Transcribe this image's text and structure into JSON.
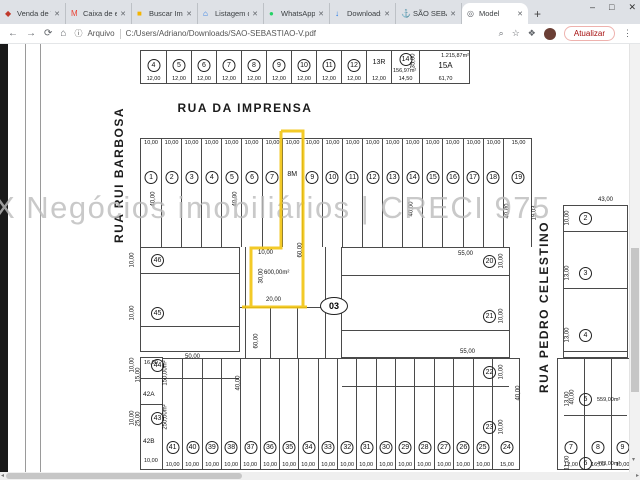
{
  "browser": {
    "tabs": [
      {
        "label": "Venda de Terr",
        "icon": "listing-pin",
        "glyph": "◆",
        "color": "#c0392b",
        "active": false
      },
      {
        "label": "Caixa de entra",
        "icon": "gmail",
        "glyph": "M",
        "color": "#ea4335",
        "active": false
      },
      {
        "label": "Buscar Imóve",
        "icon": "yellow-site",
        "glyph": "■",
        "color": "#f4b400",
        "active": false
      },
      {
        "label": "Listagem de i",
        "icon": "home-site",
        "glyph": "⌂",
        "color": "#1a73e8",
        "active": false
      },
      {
        "label": "WhatsApp",
        "icon": "whatsapp",
        "glyph": "●",
        "color": "#25d366",
        "active": false
      },
      {
        "label": "Downloads",
        "icon": "downloads",
        "glyph": "↓",
        "color": "#1a73e8",
        "active": false
      },
      {
        "label": "SÃO SEBASTI",
        "icon": "anchor",
        "glyph": "⚓",
        "color": "#34495e",
        "active": false
      },
      {
        "label": "Model",
        "icon": "globe",
        "glyph": "◎",
        "color": "#5f6368",
        "active": true
      }
    ],
    "close_glyph": "✕",
    "new_tab_glyph": "+",
    "window_controls": {
      "minimize": "–",
      "maximize": "□",
      "close": "✕"
    },
    "nav": {
      "back": "←",
      "forward": "→",
      "reload": "⟳",
      "home": "⌂",
      "info": "ⓘ"
    },
    "address": {
      "scheme_label": "Arquivo",
      "path": "C:/Users/Adriano/Downloads/SAO-SEBASTIAO-V.pdf"
    },
    "toolbar_right": {
      "zoom_glyph": "⌕",
      "bookmark_glyph": "☆",
      "extensions_glyph": "❖",
      "update_button": "Atualizar",
      "menu_glyph": "⋮"
    },
    "scroll_glyphs": {
      "down": "▾",
      "right": "▸",
      "left": "◂"
    }
  },
  "map": {
    "watermark": "X Negócios imobiliários | CRECI 975",
    "streets": {
      "top": "RUA DA IMPRENSA",
      "left": "RUA RUI BARBOSA",
      "right": "RUA PEDRO CELESTINO"
    },
    "block_label": "03",
    "highlight": {
      "lot": "8M",
      "color": "#f2c40f"
    },
    "top_block": {
      "lots": [
        {
          "label": "4",
          "circled": true,
          "dim": "12,00"
        },
        {
          "label": "5",
          "circled": true,
          "dim": "12,00"
        },
        {
          "label": "6",
          "circled": true,
          "dim": "12,00"
        },
        {
          "label": "7",
          "circled": true,
          "dim": "12,00"
        },
        {
          "label": "8",
          "circled": true,
          "dim": "12,00"
        },
        {
          "label": "9",
          "circled": true,
          "dim": "12,00"
        },
        {
          "label": "10",
          "circled": true,
          "dim": "12,00"
        },
        {
          "label": "11",
          "circled": true,
          "dim": "12,00"
        },
        {
          "label": "12",
          "circled": true,
          "dim": "12,00"
        },
        {
          "label": "13R",
          "circled": false,
          "dim": "12,00"
        },
        {
          "label": "14",
          "circled": true,
          "area": "156,97m²",
          "dim": "14,50"
        },
        {
          "label": "15A",
          "circled": false,
          "area": "1.215,87m²",
          "dim": "61,70"
        }
      ]
    },
    "front_row": {
      "lots": [
        {
          "label": "1",
          "circled": true,
          "dim": "10,00"
        },
        {
          "label": "2",
          "circled": true,
          "dim": "10,00"
        },
        {
          "label": "3",
          "circled": true,
          "dim": "10,00"
        },
        {
          "label": "4",
          "circled": true,
          "dim": "10,00"
        },
        {
          "label": "5",
          "circled": true,
          "dim": "10,00"
        },
        {
          "label": "6",
          "circled": true,
          "dim": "10,00"
        },
        {
          "label": "7",
          "circled": true,
          "dim": "10,00"
        },
        {
          "label": "8M",
          "circled": false,
          "dim": "10,00",
          "highlight": true
        },
        {
          "label": "9",
          "circled": true,
          "dim": "10,00"
        },
        {
          "label": "10",
          "circled": true,
          "dim": "10,00"
        },
        {
          "label": "11",
          "circled": true,
          "dim": "10,00"
        },
        {
          "label": "12",
          "circled": true,
          "dim": "10,00"
        },
        {
          "label": "13",
          "circled": true,
          "dim": "10,00"
        },
        {
          "label": "14",
          "circled": true,
          "dim": "10,00"
        },
        {
          "label": "15",
          "circled": true,
          "dim": "10,00"
        },
        {
          "label": "16",
          "circled": true,
          "dim": "10,00"
        },
        {
          "label": "17",
          "circled": true,
          "dim": "10,00"
        },
        {
          "label": "18",
          "circled": true,
          "dim": "10,00"
        },
        {
          "label": "19",
          "circled": true,
          "dim": "15,00"
        }
      ]
    },
    "west_block": {
      "bottom_dim": "50,00",
      "lots": [
        {
          "label": "46",
          "side": "10,00"
        },
        {
          "label": "45",
          "side": "10,00"
        },
        {
          "label": "44",
          "side": "10,00"
        },
        {
          "label": "43",
          "side": "10,00"
        }
      ]
    },
    "lot_42a": {
      "label": "42A",
      "area": "150,00m²",
      "side": "15,00",
      "top_dim": "16,00"
    },
    "lot_42b": {
      "label": "42B",
      "area": "250,00m²",
      "side": "25,00",
      "bottom_dim": "10,00"
    },
    "back_row": {
      "lots": [
        {
          "label": "41",
          "circled": true,
          "dim": "10,00"
        },
        {
          "label": "40",
          "circled": true,
          "dim": "10,00"
        },
        {
          "label": "39",
          "circled": true,
          "dim": "10,00"
        },
        {
          "label": "38",
          "circled": true,
          "dim": "10,00"
        },
        {
          "label": "37",
          "circled": true,
          "dim": "10,00"
        },
        {
          "label": "36",
          "circled": true,
          "dim": "10,00"
        },
        {
          "label": "35",
          "circled": true,
          "dim": "10,00"
        },
        {
          "label": "34",
          "circled": true,
          "dim": "10,00"
        },
        {
          "label": "33",
          "circled": true,
          "dim": "10,00"
        },
        {
          "label": "32",
          "circled": true,
          "dim": "10,00"
        },
        {
          "label": "31",
          "circled": true,
          "dim": "10,00"
        },
        {
          "label": "30",
          "circled": true,
          "dim": "10,00"
        },
        {
          "label": "29",
          "circled": true,
          "dim": "10,00"
        },
        {
          "label": "28",
          "circled": true,
          "dim": "10,00"
        },
        {
          "label": "27",
          "circled": true,
          "dim": "10,00"
        },
        {
          "label": "26",
          "circled": true,
          "dim": "10,00"
        },
        {
          "label": "25",
          "circled": true,
          "dim": "10,00"
        },
        {
          "label": "24",
          "circled": true,
          "dim": "15,00"
        }
      ]
    },
    "east_mid_block": {
      "top_dim": "55,00",
      "bottom_dim": "55,00",
      "lots": [
        {
          "label": "20",
          "side": "10,00"
        },
        {
          "label": "21",
          "side": "10,00"
        },
        {
          "label": "22",
          "side": "10,00"
        },
        {
          "label": "23",
          "side": "10,00"
        }
      ]
    },
    "east_block": {
      "top_dim": "43,00",
      "lots": [
        {
          "label": "2",
          "side": "10,00"
        },
        {
          "label": "3",
          "side": "13,00"
        },
        {
          "label": "4",
          "side": "13,00"
        },
        {
          "label": "5",
          "side": "13,00",
          "area": "559,00m²"
        },
        {
          "label": "6",
          "side": "11,00",
          "area": "473,00m²",
          "bottom_dim": "43,00"
        }
      ]
    },
    "southeast_lots": {
      "lots": [
        {
          "label": "7",
          "circled": true,
          "dim": "12,00"
        },
        {
          "label": "8",
          "circled": true,
          "dim": "16,00"
        },
        {
          "label": "9",
          "circled": true,
          "dim": "10,00"
        }
      ]
    },
    "dim_labels": [
      {
        "text": "40,00",
        "x": 146,
        "y": 196,
        "rot": true
      },
      {
        "text": "40,00",
        "x": 228,
        "y": 196,
        "rot": true
      },
      {
        "text": "40,00",
        "x": 404,
        "y": 206,
        "rot": true
      },
      {
        "text": "40,00",
        "x": 500,
        "y": 208,
        "rot": true
      },
      {
        "text": "19,03",
        "x": 527,
        "y": 210,
        "rot": true
      },
      {
        "text": "35,00",
        "x": 406,
        "y": 58,
        "rot": true
      },
      {
        "text": "60,00",
        "x": 293,
        "y": 247,
        "rot": true
      },
      {
        "text": "30,00",
        "x": 254,
        "y": 273,
        "rot": true
      },
      {
        "text": "10,00",
        "x": 258,
        "y": 250,
        "rot": false
      },
      {
        "text": "600,00m²",
        "x": 264,
        "y": 270,
        "rot": false
      },
      {
        "text": "20,00",
        "x": 266,
        "y": 297,
        "rot": false
      },
      {
        "text": "60,00",
        "x": 249,
        "y": 338,
        "rot": true
      },
      {
        "text": "40,00",
        "x": 231,
        "y": 380,
        "rot": true
      },
      {
        "text": "40,00",
        "x": 511,
        "y": 390,
        "rot": true
      },
      {
        "text": "40,00",
        "x": 565,
        "y": 394,
        "rot": true
      }
    ]
  }
}
